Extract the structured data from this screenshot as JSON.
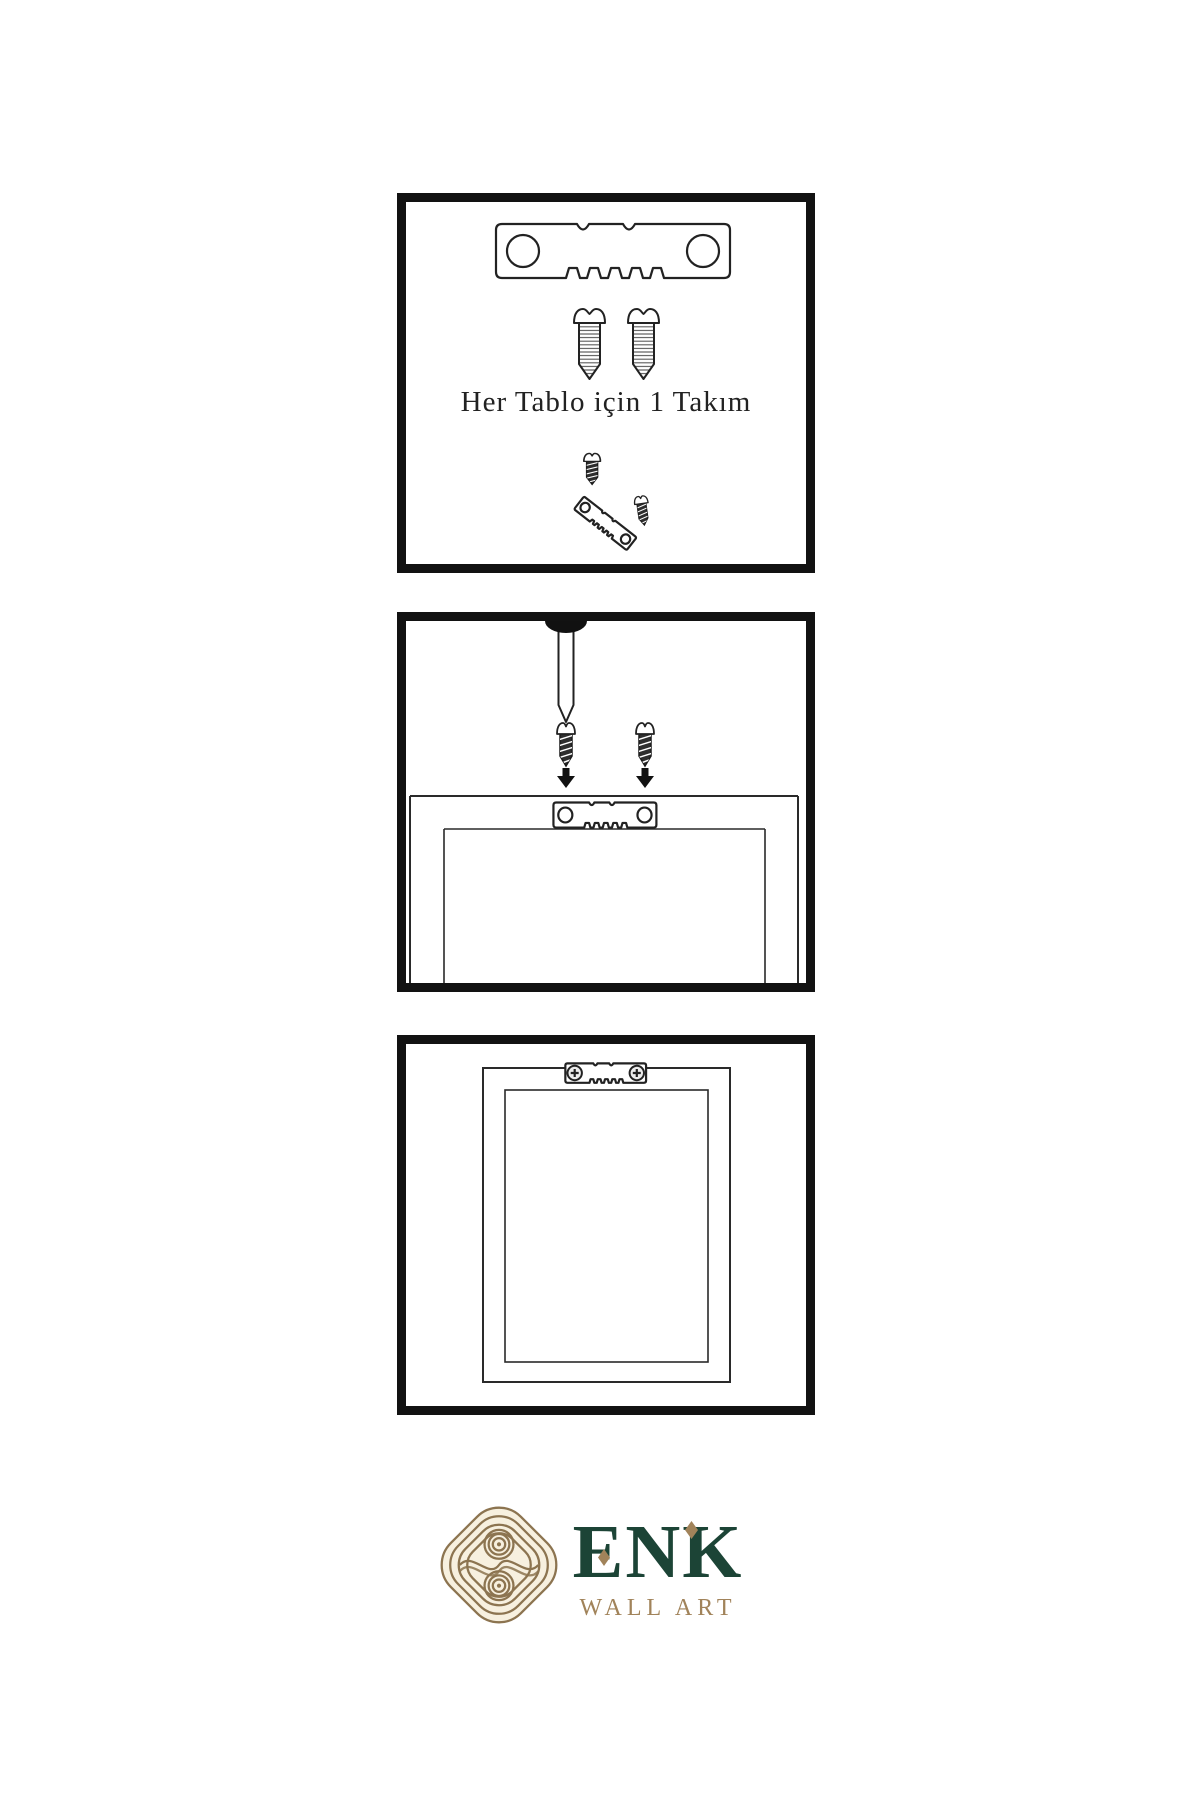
{
  "colors": {
    "ink": "#222222",
    "panel-border": "#121212",
    "logo-gold": "#8c7450",
    "logo-gold-light": "#a1835a",
    "logo-green": "#1c4436",
    "logo-cream": "#f7f0df"
  },
  "steps": {
    "step1": {
      "caption": "Her Tablo için 1 Takım",
      "icons": [
        "sawtooth-hanger-icon",
        "screw-icon",
        "screw-icon",
        "dark-screw-icon",
        "tilted-sawtooth-hanger-icon",
        "dark-screw-icon"
      ]
    },
    "step2": {
      "icons": [
        "wall-nail-icon",
        "dark-screw-icon",
        "dark-screw-icon",
        "arrow-down-icon",
        "arrow-down-icon",
        "picture-frame-back",
        "sawtooth-hanger-icon"
      ]
    },
    "step3": {
      "icons": [
        "picture-frame-back",
        "sawtooth-hanger-icon",
        "crosshead-screw-icon",
        "crosshead-screw-icon"
      ]
    }
  },
  "logo": {
    "brand": "ENK",
    "subtitle": "WALL ART"
  }
}
